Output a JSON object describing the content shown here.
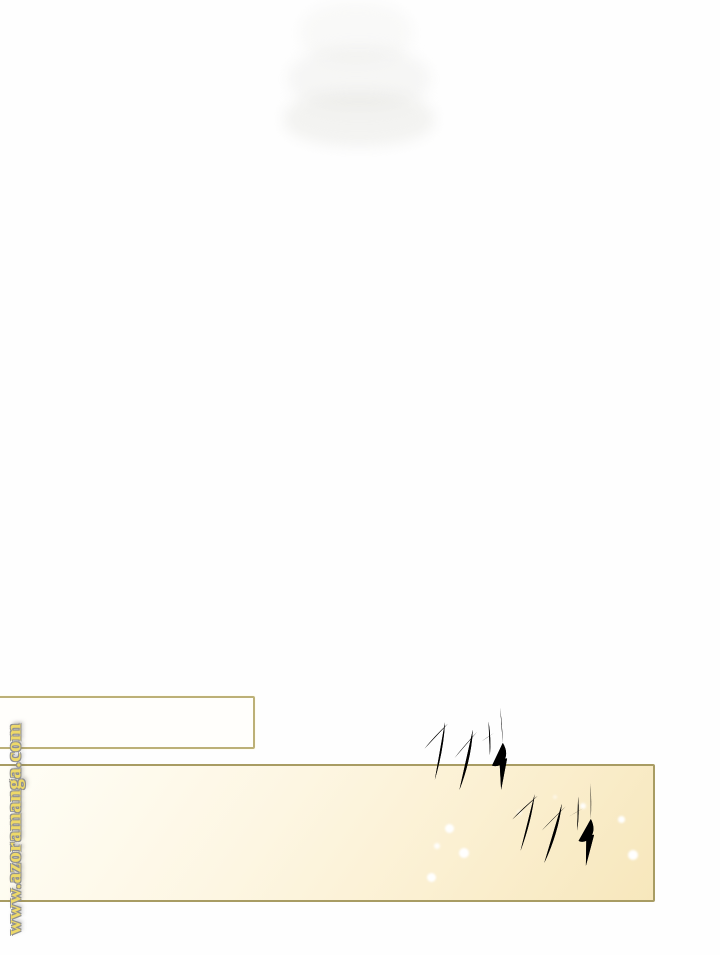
{
  "page": {
    "kind": "webtoon-manga-page",
    "background_color": "#fefefe"
  },
  "watermark": {
    "text": "www.azoramanga.com",
    "color": "#eed969",
    "outline_color": "#909090",
    "orientation": "vertical-bottom-to-top"
  },
  "sfx": {
    "items": [
      {
        "text": "짹",
        "color": "#b99ae0"
      },
      {
        "text": "짹",
        "color": "#b99ae0"
      }
    ]
  },
  "panels": {
    "caption_box": {
      "fill": "#fffefb",
      "border_color": "#bcb077",
      "text": ""
    },
    "main_panel": {
      "fill_start": "#fffef7",
      "fill_end": "#f7e7bc",
      "border_color": "#a89c63",
      "sparkle_color": "#ffffff"
    }
  }
}
